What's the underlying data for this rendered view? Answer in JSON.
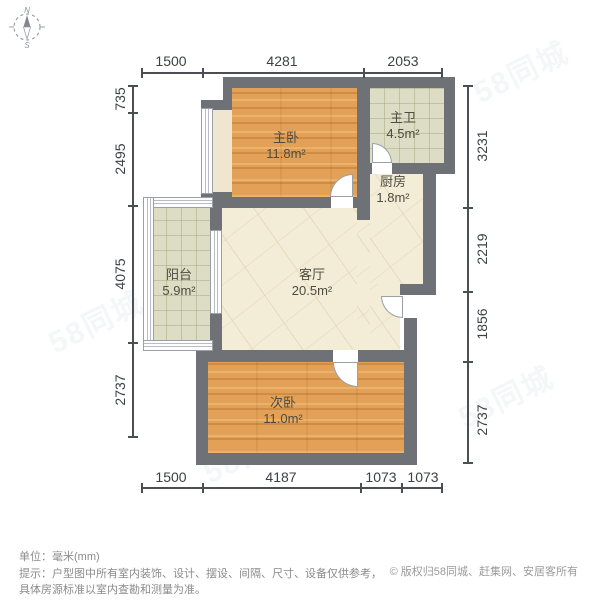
{
  "compass": {
    "north": "N",
    "south": "S"
  },
  "watermark": {
    "text": "58同城"
  },
  "rooms": {
    "master_bedroom": {
      "name": "主卧",
      "area": "11.8m²"
    },
    "master_bath": {
      "name": "主卫",
      "area": "4.5m²"
    },
    "kitchen": {
      "name": "厨房",
      "area": "1.8m²"
    },
    "living_room": {
      "name": "客厅",
      "area": "20.5m²"
    },
    "balcony": {
      "name": "阳台",
      "area": "5.9m²"
    },
    "second_bedroom": {
      "name": "次卧",
      "area": "11.0m²"
    }
  },
  "dimensions": {
    "top": [
      "1500",
      "4281",
      "2053"
    ],
    "bottom": [
      "1500",
      "4187",
      "1073",
      "1073"
    ],
    "left": [
      "735",
      "2495",
      "4075",
      "2737"
    ],
    "right": [
      "3231",
      "2219",
      "1856",
      "2737"
    ]
  },
  "footer": {
    "unit": "单位：毫米(mm)",
    "hint_line1": "提示：户型图中所有室内装饰、设计、摆设、间隔、尺寸、设备仅供参考，",
    "hint_line2": "具体房源标准以室内查勘和测量为准。",
    "copyright": "© 版权归58同城、赶集网、安居客所有"
  },
  "colors": {
    "wall": "#6e7277",
    "wood_floor": "#e2a156",
    "tile_floor": "#dcddc4",
    "marble_floor": "#f3ecd7",
    "dimension_text": "#3d4144",
    "hint_text": "#8b8b8b"
  }
}
